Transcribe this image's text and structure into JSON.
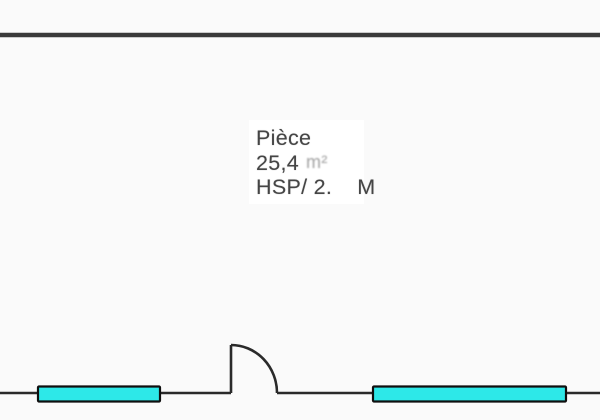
{
  "room": {
    "name": "Pièce",
    "area_value": "25,4",
    "area_unit": "m²",
    "height_label": "HSP/ 2.",
    "height_unit": "M"
  },
  "colors": {
    "background": "#fafafa",
    "panel": "#ffffff",
    "wall": "#3a3a3a",
    "line": "#2a2a2a",
    "window_fill": "#2de8e8",
    "window_border": "#0f0f0f",
    "text": "#454545"
  }
}
